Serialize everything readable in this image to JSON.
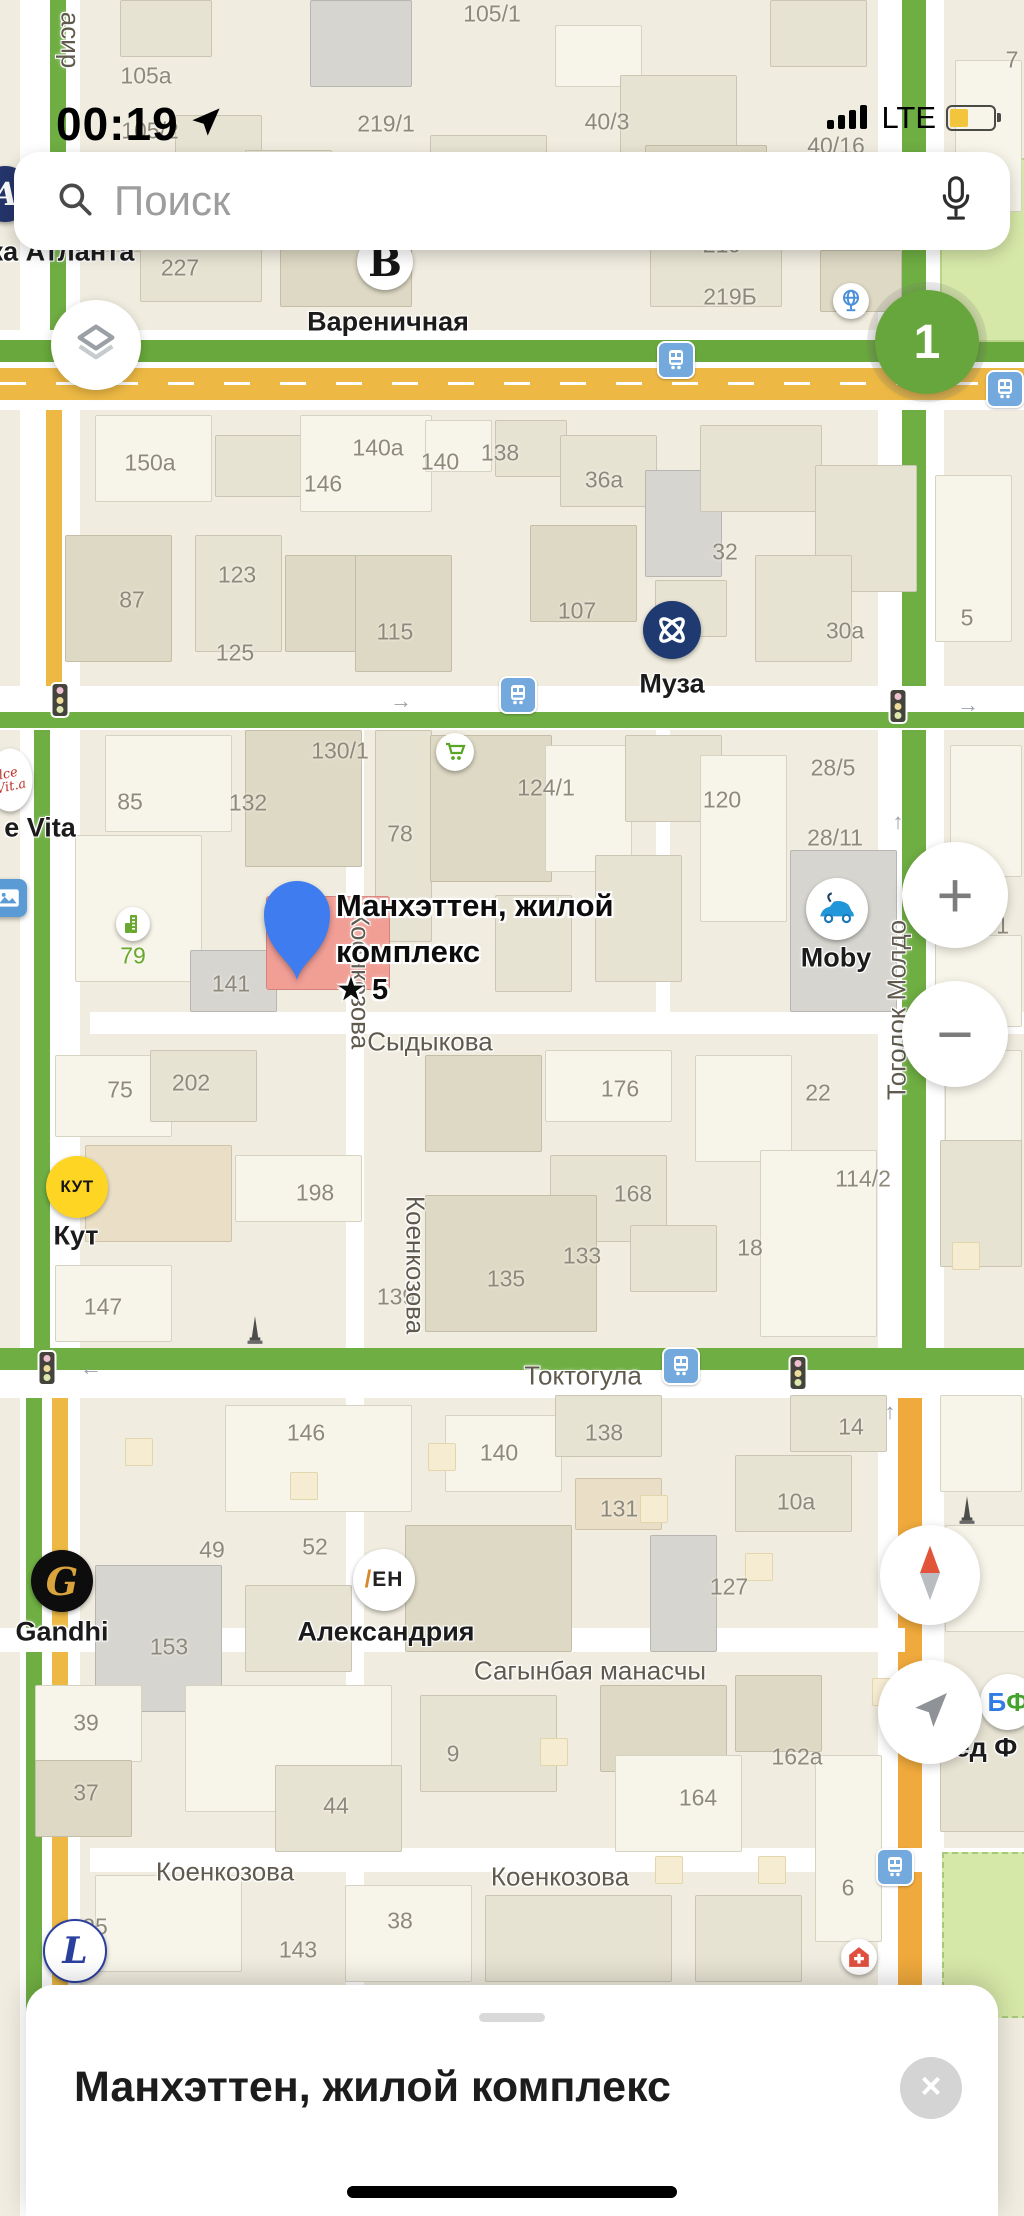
{
  "status_bar": {
    "time": "00:19",
    "network": "LTE"
  },
  "search": {
    "placeholder": "Поиск"
  },
  "controls": {
    "route_count": "1",
    "zoom_in": "+",
    "zoom_out": "−"
  },
  "bottom_sheet": {
    "title": "Манхэттен, жилой комплекс",
    "close_icon": "×"
  },
  "map": {
    "selected_place": {
      "line1": "Манхэттен, жилой",
      "line2": "комплекс",
      "rating": "★ 5"
    },
    "street_labels": [
      [
        "Сыдыкова",
        430,
        1042,
        0
      ],
      [
        "Токтогула",
        583,
        1376,
        0
      ],
      [
        "Сагынбая манасчы",
        590,
        1671,
        0
      ],
      [
        "Коенкозова",
        225,
        1872,
        0
      ],
      [
        "Коенкозова",
        560,
        1877,
        0
      ],
      [
        "Коенкозова",
        360,
        980,
        90
      ],
      [
        "Коенкозова",
        415,
        1265,
        90
      ],
      [
        "Тоголок Молдо",
        897,
        1010,
        -90
      ],
      [
        "асир",
        70,
        40,
        90
      ]
    ],
    "building_numbers": [
      [
        "105/1",
        492,
        14
      ],
      [
        "40/3",
        607,
        122
      ],
      [
        "40/16",
        836,
        146
      ],
      [
        "7",
        1012,
        60
      ],
      [
        "105a",
        146,
        76
      ],
      [
        "105/2",
        150,
        131
      ],
      [
        "219/1",
        386,
        124
      ],
      [
        "227",
        180,
        268
      ],
      [
        "219",
        722,
        245
      ],
      [
        "219Б",
        730,
        297
      ],
      [
        "150a",
        150,
        463
      ],
      [
        "146",
        323,
        484
      ],
      [
        "140a",
        378,
        448
      ],
      [
        "140",
        440,
        462
      ],
      [
        "138",
        500,
        453
      ],
      [
        "36a",
        604,
        480
      ],
      [
        "123",
        237,
        575
      ],
      [
        "87",
        132,
        600
      ],
      [
        "32",
        725,
        552
      ],
      [
        "107",
        577,
        611
      ],
      [
        "115",
        395,
        632
      ],
      [
        "125",
        235,
        653
      ],
      [
        "30a",
        845,
        631
      ],
      [
        "5",
        967,
        618
      ],
      [
        "130/1",
        340,
        751
      ],
      [
        "124/1",
        546,
        788
      ],
      [
        "85",
        130,
        802
      ],
      [
        "132",
        248,
        803
      ],
      [
        "120",
        722,
        800
      ],
      [
        "28/5",
        833,
        768
      ],
      [
        "28/11",
        835,
        838
      ],
      [
        "78",
        400,
        834
      ],
      [
        "4/1",
        993,
        926
      ],
      [
        "141",
        231,
        984
      ],
      [
        "202",
        191,
        1083
      ],
      [
        "75",
        120,
        1090
      ],
      [
        "176",
        620,
        1089
      ],
      [
        "22",
        818,
        1093
      ],
      [
        "114/2",
        863,
        1179
      ],
      [
        "198",
        315,
        1193
      ],
      [
        "168",
        633,
        1194
      ],
      [
        "18",
        750,
        1248
      ],
      [
        "133",
        582,
        1256
      ],
      [
        "135",
        506,
        1279
      ],
      [
        "139",
        396,
        1297
      ],
      [
        "147",
        103,
        1307
      ],
      [
        "146",
        306,
        1433
      ],
      [
        "140",
        499,
        1453
      ],
      [
        "138",
        604,
        1433
      ],
      [
        "14",
        851,
        1427
      ],
      [
        "131",
        619,
        1509
      ],
      [
        "10a",
        796,
        1502
      ],
      [
        "49",
        212,
        1550
      ],
      [
        "52",
        315,
        1547
      ],
      [
        "127",
        729,
        1587
      ],
      [
        "153",
        169,
        1647
      ],
      [
        "162a",
        797,
        1757
      ],
      [
        "164",
        698,
        1798
      ],
      [
        "39",
        86,
        1723
      ],
      [
        "37",
        86,
        1793
      ],
      [
        "44",
        336,
        1806
      ],
      [
        "9",
        453,
        1754
      ],
      [
        "38",
        400,
        1921
      ],
      [
        "143",
        298,
        1950
      ],
      [
        "25",
        95,
        1927
      ],
      [
        "6",
        848,
        1888
      ],
      [
        "79",
        133,
        956,
        "#69a82f"
      ]
    ],
    "poi": [
      {
        "id": "hotel-atlanta",
        "x": 5,
        "y": 194,
        "r": 28,
        "bg": "#24356b",
        "icon": "letter-a-script",
        "label": "ка Атланта",
        "lx": 62,
        "ly": 252
      },
      {
        "id": "varenichnaya",
        "x": 385,
        "y": 262,
        "r": 28,
        "bg": "#ffffff",
        "icon": "letter-b-serif",
        "label": "Вареничная",
        "lx": 388,
        "ly": 322
      },
      {
        "id": "globe-poi",
        "x": 851,
        "y": 301,
        "r": 18,
        "bg": "#ffffff",
        "icon": "globe"
      },
      {
        "id": "muza",
        "x": 672,
        "y": 630,
        "r": 29,
        "bg": "#1e3a70",
        "icon": "knot",
        "label": "Муза",
        "lx": 672,
        "ly": 684
      },
      {
        "id": "grocery",
        "x": 455,
        "y": 752,
        "r": 19,
        "bg": "#ffffff",
        "icon": "cart"
      },
      {
        "id": "building-79",
        "x": 133,
        "y": 924,
        "r": 17,
        "bg": "#ffffff",
        "icon": "building"
      },
      {
        "id": "dolce-vita",
        "x": 10,
        "y": 780,
        "r": 30,
        "bg": "#ffffff",
        "icon": "dolce",
        "shape": "oval",
        "label": "e Vita",
        "lx": 40,
        "ly": 828
      },
      {
        "id": "gallery",
        "x": 8,
        "y": 898,
        "r": 19,
        "bg": "#5b9bd5",
        "icon": "picture",
        "shape": "square"
      },
      {
        "id": "moby",
        "x": 837,
        "y": 909,
        "r": 31,
        "bg": "#ffffff",
        "icon": "car",
        "label": "Moby",
        "lx": 836,
        "ly": 958
      },
      {
        "id": "kut",
        "x": 77,
        "y": 1187,
        "r": 31,
        "bg": "#ffd524",
        "icon": "kut-text",
        "label": "Кут",
        "lx": 76,
        "ly": 1236
      },
      {
        "id": "monument-1",
        "x": 255,
        "y": 1330,
        "icon": "obelisk",
        "shape": "none"
      },
      {
        "id": "monument-2",
        "x": 967,
        "y": 1510,
        "icon": "obelisk",
        "shape": "none"
      },
      {
        "id": "gandhi",
        "x": 62,
        "y": 1581,
        "r": 31,
        "bg": "#0d0d0d",
        "icon": "letter-g-script",
        "label": "Gandhi",
        "lx": 62,
        "ly": 1632
      },
      {
        "id": "alexandria",
        "x": 384,
        "y": 1580,
        "r": 31,
        "bg": "#ffffff",
        "icon": "en-logo",
        "label": "Александрия",
        "lx": 386,
        "ly": 1632
      },
      {
        "id": "l-club",
        "x": 75,
        "y": 1951,
        "r": 30,
        "bg": "#ffffff",
        "icon": "letter-l-script",
        "ring": "#2b3f9e"
      },
      {
        "id": "pharmacy",
        "x": 859,
        "y": 1957,
        "r": 18,
        "bg": "#ffffff",
        "icon": "med-cross"
      },
      {
        "id": "bf-poi",
        "x": 1008,
        "y": 1702,
        "r": 28,
        "bg": "#ffffff",
        "icon": "bf-letters",
        "label": "ед Ф",
        "lx": 986,
        "ly": 1748
      }
    ],
    "bus_stops": [
      [
        676,
        360
      ],
      [
        1005,
        389
      ],
      [
        518,
        695
      ],
      [
        681,
        1366
      ],
      [
        895,
        1867
      ]
    ],
    "traffic_lights": [
      [
        60,
        700
      ],
      [
        898,
        706
      ],
      [
        798,
        1373
      ],
      [
        47,
        1368
      ]
    ],
    "one_way_arrows": [
      [
        "→",
        401,
        701
      ],
      [
        "→",
        968,
        705
      ],
      [
        "↑",
        898,
        822
      ],
      [
        "←",
        91,
        1368
      ],
      [
        "↑",
        890,
        1412
      ]
    ]
  }
}
